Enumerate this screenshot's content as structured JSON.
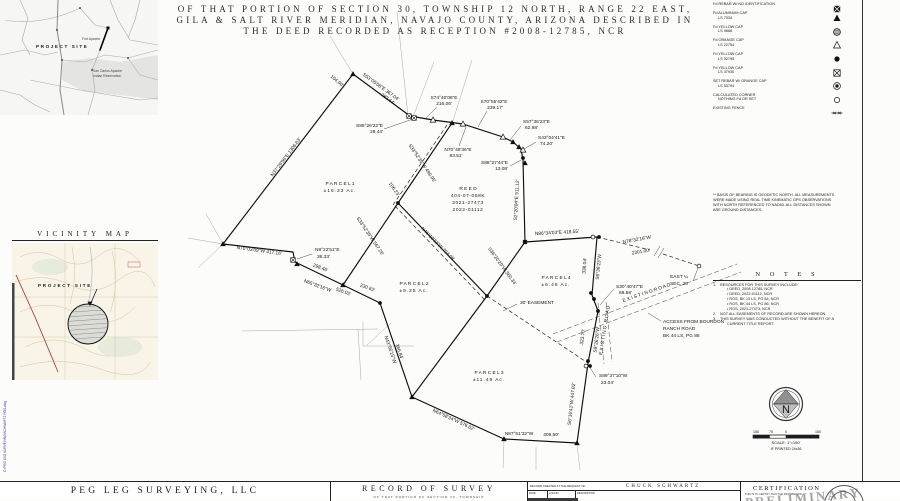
{
  "title_block": {
    "line1": "OF THAT PORTION OF SECTION 30, TOWNSHIP 12 NORTH, RANGE 22 EAST,",
    "line2": "GILA & SALT RIVER MERIDIAN, NAVAJO COUNTY, ARIZONA DESCRIBED IN",
    "line3": "THE DEED RECORDED AS RECEPTION #2008-12785, NCR"
  },
  "state_map": {
    "project_site": "PROJECT SITE",
    "label_fort_apache": "Fort Apache",
    "label_reservation_1": "San Carlos Apache",
    "label_reservation_2": "Indian Reservation"
  },
  "vicinity_map": {
    "title": "VICINITY MAP",
    "project_site": "PROJECT SITE"
  },
  "legend": {
    "items": [
      {
        "l1": "Fd REBAR W/  NO IDENTIFICATION",
        "l2": "",
        "sym": "square-x-filled"
      },
      {
        "l1": "Fd ALUMINUM CAP",
        "l2": "LS 7334",
        "sym": "triangle-filled"
      },
      {
        "l1": "Fd YELLOW CAP",
        "l2": "LS 9868",
        "sym": "circle-hatched"
      },
      {
        "l1": "Fd ORANGE CAP",
        "l2": "LS 22754",
        "sym": "triangle-open"
      },
      {
        "l1": "Fd YELLOW CAP",
        "l2": "LS 32795",
        "sym": "circle-filled"
      },
      {
        "l1": "Fd YELLOW CAP",
        "l2": "LS 37930",
        "sym": "square-x"
      },
      {
        "l1": "SET REBAR W/ ORANGE CAP",
        "l2": "LS 53794",
        "sym": "circle-target"
      },
      {
        "l1": "CALCULATED CORNER",
        "l2": "NOTHING Fd OR SET",
        "sym": "circle-open"
      },
      {
        "l1": "EXISTING FENCE",
        "l2": "",
        "sym": "fence-line"
      }
    ]
  },
  "basis_note": [
    "** BASIS OF BEARING IS GEODETIC NORTH. ALL MEASUREMENTS",
    "WERE MADE USING REAL TIME KINEMATIC GPS OBSERVATIONS",
    "WITH NORTH REFERENCED TO NAD83. ALL DISTANCES SHOWN",
    "ARE GROUND DISTANCES."
  ],
  "notes": {
    "title": "N O T E S",
    "items": [
      {
        "n": "1.",
        "t": "RESOURCES FOR THIS SURVEY INCLUDE:"
      },
      {
        "n": "",
        "t": "• DEED, 2008-12785, NCR"
      },
      {
        "n": "",
        "t": "• DEED, 2022-01112, NCR"
      },
      {
        "n": "",
        "t": "• ROS, BK 13 LS, PG 84, NCR"
      },
      {
        "n": "",
        "t": "• ROS, BK 44 LS, PG 86, NCR"
      },
      {
        "n": "",
        "t": "• ROS, 2021-27473, NCR"
      },
      {
        "n": "2.",
        "t": "NOT ALL EASEMENTS OF RECORD ARE SHOWN HEREON."
      },
      {
        "n": "3.",
        "t": "THIS SURVEY WAS CONDUCTED WITHOUT THE BENEFIT OF A"
      },
      {
        "n": "",
        "t": "CURRENT TITLE REPORT."
      }
    ]
  },
  "north_scale": {
    "n_letter": "N",
    "ticks": [
      "150",
      "75",
      "0",
      "150"
    ],
    "scale_text": "SCALE: 1\"=150'",
    "print_text": "IF PRINTED 24x36"
  },
  "footer": {
    "firm": "PEG LEG SURVEYING, LLC",
    "doc_title": "RECORD OF SURVEY",
    "doc_sub": "OF THAT PORTION OF SECTION 30, TOWNSHIP",
    "request_label": "RECORD CREATED AT THE REQUEST OF:",
    "client": "CHUCK SCHWARTZ",
    "rev_cols": [
      "DATE",
      "LOG/JN",
      "DESCRIPTION"
    ],
    "cert_title": "CERTIFICATION",
    "cert_body": "THIS IS TO CERTIFY THAT THE INFORMATION",
    "stamp": "PRELIMINARY",
    "side_file_text": "C:\\PEG LEG SURVEYING\\SCHWARTZ ROS.dwg"
  },
  "plat": {
    "solid": [
      [
        [
          353,
          74
        ],
        [
          410,
          116
        ],
        [
          433,
          120
        ],
        [
          463,
          124
        ],
        [
          503,
          137
        ],
        [
          513,
          142
        ],
        [
          521,
          149
        ],
        [
          523,
          160
        ],
        [
          525,
          242
        ]
      ],
      [
        [
          525,
          242
        ],
        [
          597,
          237
        ]
      ],
      [
        [
          597,
          237
        ],
        [
          592,
          295
        ],
        [
          598,
          311
        ],
        [
          588,
          363
        ],
        [
          577,
          443
        ],
        [
          504,
          439
        ],
        [
          412,
          397
        ],
        [
          380,
          303
        ],
        [
          343,
          285
        ],
        [
          295,
          262
        ],
        [
          293,
          252
        ],
        [
          223,
          244
        ],
        [
          353,
          74
        ]
      ],
      [
        [
          452,
          123
        ],
        [
          398,
          203
        ],
        [
          343,
          285
        ]
      ],
      [
        [
          398,
          203
        ],
        [
          487,
          296
        ]
      ],
      [
        [
          525,
          242
        ],
        [
          487,
          296
        ]
      ],
      [
        [
          487,
          296
        ],
        [
          412,
          397
        ]
      ]
    ],
    "dashed": [
      [
        [
          597,
          237
        ],
        [
          650,
          250
        ]
      ],
      [
        [
          663,
          254
        ],
        [
          699,
          266
        ]
      ],
      [
        [
          487,
          296
        ],
        [
          588,
          363
        ]
      ],
      [
        [
          447,
          125
        ],
        [
          393,
          205
        ]
      ],
      [
        [
          395,
          206
        ],
        [
          484,
          299
        ]
      ]
    ],
    "roads": [
      [
        [
          553,
          334
        ],
        [
          737,
          264
        ]
      ],
      [
        [
          557,
          342
        ],
        [
          741,
          272
        ]
      ],
      [
        [
          598,
          303
        ],
        [
          604,
          364
        ]
      ],
      [
        [
          606,
          302
        ],
        [
          612,
          362
        ]
      ]
    ],
    "gray": [
      [
        [
          397,
          12
        ],
        [
          408,
          116
        ]
      ],
      [
        [
          434,
          62
        ],
        [
          413,
          117
        ]
      ],
      [
        [
          472,
          60
        ],
        [
          452,
          124
        ]
      ],
      [
        [
          330,
          36
        ],
        [
          353,
          74
        ]
      ],
      [
        [
          206,
          214
        ],
        [
          223,
          244
        ]
      ],
      [
        [
          188,
          238
        ],
        [
          223,
          244
        ]
      ],
      [
        [
          198,
          268
        ],
        [
          223,
          244
        ]
      ],
      [
        [
          242,
          331
        ],
        [
          378,
          329
        ]
      ],
      [
        [
          358,
          329
        ],
        [
          361,
          380
        ]
      ],
      [
        [
          363,
          322
        ],
        [
          363,
          346
        ]
      ],
      [
        [
          363,
          346
        ],
        [
          414,
          346
        ]
      ],
      [
        [
          367,
          345
        ],
        [
          391,
          323
        ]
      ],
      [
        [
          504,
          441
        ],
        [
          503,
          468
        ]
      ],
      [
        [
          536,
          447
        ],
        [
          536,
          470
        ]
      ],
      [
        [
          577,
          445
        ],
        [
          580,
          470
        ]
      ]
    ],
    "leaders": [
      [
        [
          384,
          129
        ],
        [
          413,
          119
        ]
      ],
      [
        [
          437,
          107
        ],
        [
          426,
          118
        ]
      ],
      [
        [
          487,
          111
        ],
        [
          478,
          127
        ]
      ],
      [
        [
          521,
          126
        ],
        [
          510,
          140
        ]
      ],
      [
        [
          536,
          142
        ],
        [
          524,
          149
        ]
      ],
      [
        [
          510,
          166
        ],
        [
          521,
          160
        ]
      ],
      [
        [
          459,
          146
        ],
        [
          466,
          127
        ]
      ],
      [
        [
          614,
          289
        ],
        [
          600,
          305
        ]
      ],
      [
        [
          661,
          321
        ],
        [
          648,
          313
        ]
      ],
      [
        [
          596,
          377
        ],
        [
          589,
          366
        ]
      ],
      [
        [
          312,
          254
        ],
        [
          297,
          259
        ]
      ],
      [
        [
          517,
          304
        ],
        [
          503,
          311
        ]
      ],
      [
        [
          698,
          268
        ],
        [
          693,
          281
        ]
      ],
      [
        [
          654,
          256
        ],
        [
          660,
          246
        ]
      ],
      [
        [
          658,
          258
        ],
        [
          664,
          248
        ]
      ]
    ],
    "markers": [
      {
        "x": 353,
        "y": 74,
        "t": "ft"
      },
      {
        "x": 409,
        "y": 116,
        "t": "xs"
      },
      {
        "x": 414,
        "y": 118,
        "t": "xs"
      },
      {
        "x": 433,
        "y": 120,
        "t": "ot"
      },
      {
        "x": 452,
        "y": 123,
        "t": "ft"
      },
      {
        "x": 463,
        "y": 124,
        "t": "ot"
      },
      {
        "x": 503,
        "y": 137,
        "t": "ot"
      },
      {
        "x": 513,
        "y": 142,
        "t": "ft"
      },
      {
        "x": 519,
        "y": 147,
        "t": "ft"
      },
      {
        "x": 523,
        "y": 150,
        "t": "ot"
      },
      {
        "x": 523,
        "y": 158,
        "t": "fc"
      },
      {
        "x": 525,
        "y": 163,
        "t": "ft"
      },
      {
        "x": 525,
        "y": 242,
        "t": "fs"
      },
      {
        "x": 593,
        "y": 237,
        "t": "oc"
      },
      {
        "x": 599,
        "y": 237,
        "t": "fc"
      },
      {
        "x": 699,
        "y": 266,
        "t": "oc"
      },
      {
        "x": 591,
        "y": 293,
        "t": "fc"
      },
      {
        "x": 594,
        "y": 299,
        "t": "fc"
      },
      {
        "x": 598,
        "y": 311,
        "t": "fc"
      },
      {
        "x": 588,
        "y": 361,
        "t": "fc"
      },
      {
        "x": 586,
        "y": 366,
        "t": "oc"
      },
      {
        "x": 590,
        "y": 366,
        "t": "fc"
      },
      {
        "x": 577,
        "y": 443,
        "t": "ft"
      },
      {
        "x": 504,
        "y": 439,
        "t": "ft"
      },
      {
        "x": 412,
        "y": 397,
        "t": "ft"
      },
      {
        "x": 380,
        "y": 303,
        "t": "fc"
      },
      {
        "x": 343,
        "y": 285,
        "t": "ft"
      },
      {
        "x": 293,
        "y": 260,
        "t": "xs"
      },
      {
        "x": 297,
        "y": 264,
        "t": "ft"
      },
      {
        "x": 223,
        "y": 244,
        "t": "ft"
      },
      {
        "x": 398,
        "y": 203,
        "t": "fc"
      },
      {
        "x": 487,
        "y": 296,
        "t": "fc"
      }
    ],
    "labels": [
      {
        "t": "S53°05'08\"E  367.04'",
        "x": 380,
        "y": 88,
        "r": 36
      },
      {
        "t": "283.64'",
        "x": 387,
        "y": 100,
        "r": 36
      },
      {
        "t": "104.00'",
        "x": 336,
        "y": 82,
        "r": 40
      },
      {
        "t": "S88°26'22\"E",
        "x": 383,
        "y": 127,
        "a": "end"
      },
      {
        "t": "29.44'",
        "x": 383,
        "y": 133,
        "a": "end"
      },
      {
        "t": "S74°40'06\"E",
        "x": 444,
        "y": 99
      },
      {
        "t": "216.06'",
        "x": 444,
        "y": 105
      },
      {
        "t": "S70°55'42\"E",
        "x": 494,
        "y": 103
      },
      {
        "t": "239.17'",
        "x": 495,
        "y": 109
      },
      {
        "t": "S57°36'23\"E",
        "x": 523,
        "y": 123,
        "a": "start"
      },
      {
        "t": "62.98'",
        "x": 525,
        "y": 129,
        "a": "start"
      },
      {
        "t": "S43°04'41\"E",
        "x": 538,
        "y": 139,
        "a": "start"
      },
      {
        "t": "74.20'",
        "x": 540,
        "y": 145,
        "a": "start"
      },
      {
        "t": "S88°27'44\"E",
        "x": 508,
        "y": 164,
        "a": "end"
      },
      {
        "t": "13.08'",
        "x": 508,
        "y": 170,
        "a": "end"
      },
      {
        "t": "N70°48'36\"E",
        "x": 458,
        "y": 151
      },
      {
        "t": "83.51'",
        "x": 456,
        "y": 157
      },
      {
        "t": "N37°29'56\"E  1306.63'",
        "x": 287,
        "y": 158,
        "r": -53
      },
      {
        "t": "S33°52'39\"W  499.95'",
        "x": 421,
        "y": 164,
        "r": 56
      },
      {
        "t": "106.23'",
        "x": 393,
        "y": 190,
        "r": 56
      },
      {
        "t": "S33°52'39\"W  567.26'",
        "x": 369,
        "y": 237,
        "r": 56
      },
      {
        "t": "N46°10'23\"W  704.08'",
        "x": 437,
        "y": 245,
        "r": 45
      },
      {
        "t": "S2°20'04\"E  911.12'",
        "x": 518,
        "y": 200,
        "r": -87
      },
      {
        "t": "S36°20'29\"W  360.34'",
        "x": 501,
        "y": 267,
        "r": 54
      },
      {
        "t": "N86°34'03\"E  418.55'",
        "x": 557,
        "y": 234,
        "r": -3
      },
      {
        "t": "N78°32'16\"W",
        "x": 637,
        "y": 241,
        "r": -10
      },
      {
        "t": "2301.00'",
        "x": 641,
        "y": 253,
        "r": -10
      },
      {
        "t": "EAST ¼",
        "x": 679,
        "y": 278
      },
      {
        "t": "SEC. 30",
        "x": 679,
        "y": 285
      },
      {
        "t": "338.04'",
        "x": 586,
        "y": 266,
        "r": -85
      },
      {
        "t": "S6°36'23\"W",
        "x": 600,
        "y": 267,
        "r": -85
      },
      {
        "t": "S30°40'47\"E",
        "x": 616,
        "y": 288,
        "a": "start"
      },
      {
        "t": "68.58'",
        "x": 619,
        "y": 294,
        "a": "start"
      },
      {
        "t": "E X I S T I N G   R O A D",
        "x": 647,
        "y": 294,
        "r": -19
      },
      {
        "t": "EXISTING ROAD",
        "x": 606,
        "y": 330,
        "r": -81,
        "ls": 1
      },
      {
        "t": "ACCESS FROM BOURDON",
        "x": 663,
        "y": 323,
        "a": "start"
      },
      {
        "t": "RANCH ROAD",
        "x": 663,
        "y": 330,
        "a": "start"
      },
      {
        "t": "BK 44 LS, PG 86",
        "x": 663,
        "y": 337,
        "a": "start"
      },
      {
        "t": "323.70'",
        "x": 584,
        "y": 337,
        "r": -83
      },
      {
        "t": "S9°26'26\"W",
        "x": 598,
        "y": 340,
        "r": -83
      },
      {
        "t": "S89°37'10\"W",
        "x": 599,
        "y": 377,
        "a": "start"
      },
      {
        "t": "23.04'",
        "x": 601,
        "y": 384,
        "a": "start"
      },
      {
        "t": "S6°16'41\"W  447.82'",
        "x": 573,
        "y": 404,
        "r": -84
      },
      {
        "t": "N87°51'32\"W",
        "x": 519,
        "y": 435
      },
      {
        "t": "409.50'",
        "x": 551,
        "y": 436
      },
      {
        "t": "N64°58'34\"W  576.02'",
        "x": 453,
        "y": 421,
        "r": 25
      },
      {
        "t": "N43°56'15\"W",
        "x": 389,
        "y": 350,
        "r": 71
      },
      {
        "t": "366.84'",
        "x": 398,
        "y": 352,
        "r": 71
      },
      {
        "t": "298.46'",
        "x": 320,
        "y": 269,
        "r": 20
      },
      {
        "t": "N65°32'16\"W",
        "x": 317,
        "y": 287,
        "r": 20
      },
      {
        "t": "526.02'",
        "x": 343,
        "y": 293,
        "r": 20
      },
      {
        "t": "230.62'",
        "x": 367,
        "y": 289,
        "r": 20
      },
      {
        "t": "N8°22'51\"E",
        "x": 315,
        "y": 251,
        "a": "start"
      },
      {
        "t": "36.33'",
        "x": 317,
        "y": 258,
        "a": "start"
      },
      {
        "t": "N70°03'09\"W  417.16'",
        "x": 259,
        "y": 252,
        "r": 8
      },
      {
        "t": "R E E D",
        "x": 468,
        "y": 190
      },
      {
        "t": "404-07-058K",
        "x": 468,
        "y": 197,
        "ls": 0.6
      },
      {
        "t": "2021-27473",
        "x": 468,
        "y": 204,
        "ls": 0.6
      },
      {
        "t": "2022-01112",
        "x": 468,
        "y": 211,
        "ls": 0.6
      },
      {
        "t": "P A R C E L   1",
        "x": 340,
        "y": 185
      },
      {
        "t": "±16.33  Ac.",
        "x": 340,
        "y": 192,
        "ls": 1
      },
      {
        "t": "P A R C E L   2",
        "x": 414,
        "y": 285
      },
      {
        "t": "±9.25  Ac.",
        "x": 414,
        "y": 292,
        "ls": 1
      },
      {
        "t": "P A R C E L   3",
        "x": 489,
        "y": 374
      },
      {
        "t": "±11.49  Ac.",
        "x": 489,
        "y": 381,
        "ls": 1
      },
      {
        "t": "P A R C E L   4",
        "x": 556,
        "y": 279
      },
      {
        "t": "±6.45  Ac.",
        "x": 556,
        "y": 286,
        "ls": 1
      },
      {
        "t": "30' EASEMENT",
        "x": 520,
        "y": 304,
        "a": "start"
      }
    ]
  }
}
